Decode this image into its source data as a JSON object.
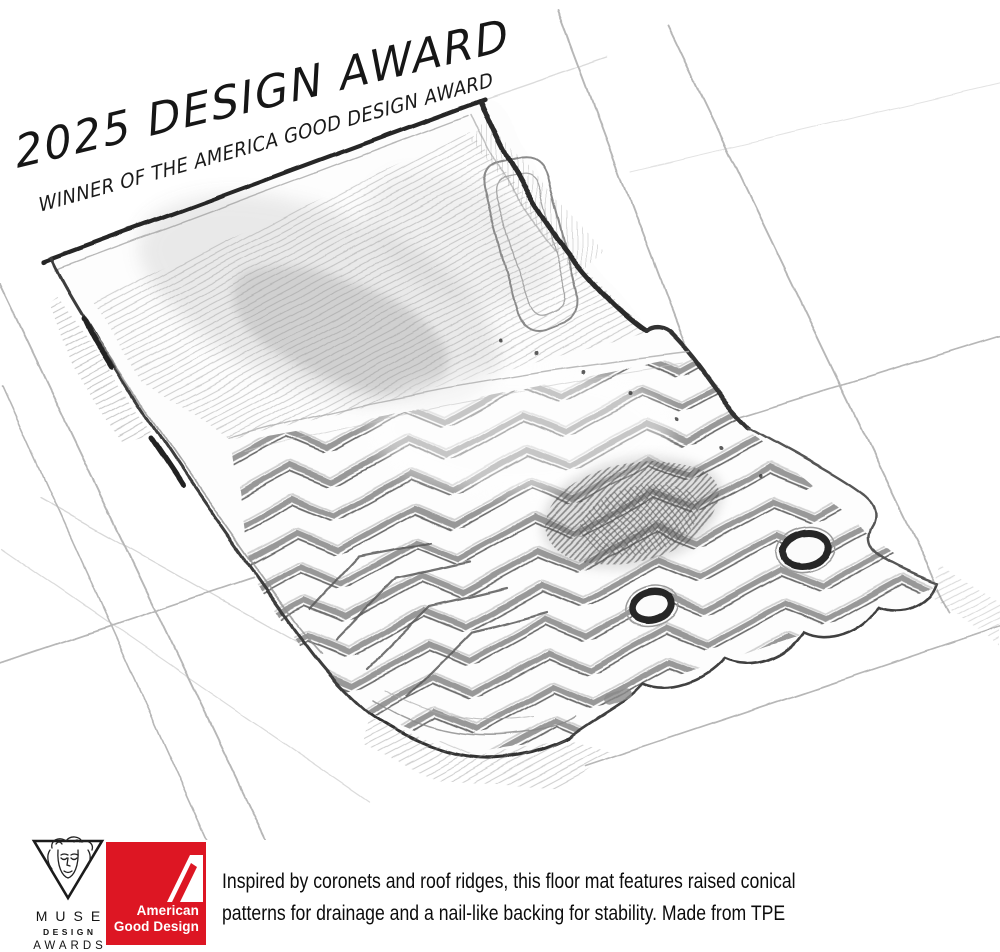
{
  "banner": {
    "title": "2025 DESIGN AWARD",
    "subtitle": "WINNER OF THE AMERICA GOOD DESIGN AWARD"
  },
  "badges": {
    "muse": {
      "word1": "MUSE",
      "word2": "DESIGN",
      "word3": "AWARDS"
    },
    "american_good_design": {
      "line1": "American",
      "line2": "Good Design",
      "brand_color": "#DD1623"
    }
  },
  "caption": {
    "line1": "Inspired by coronets and roof ridges, this floor mat features raised conical",
    "line2": "patterns for drainage and a nail-like backing for stability. Made from TPE"
  },
  "sketch": {
    "subject": "pencil sketch of a car floor mat on a perspective grid",
    "pencil_dark": "#2c2c2c",
    "pencil_mid": "#707070",
    "pencil_light": "#b0b0b0"
  }
}
